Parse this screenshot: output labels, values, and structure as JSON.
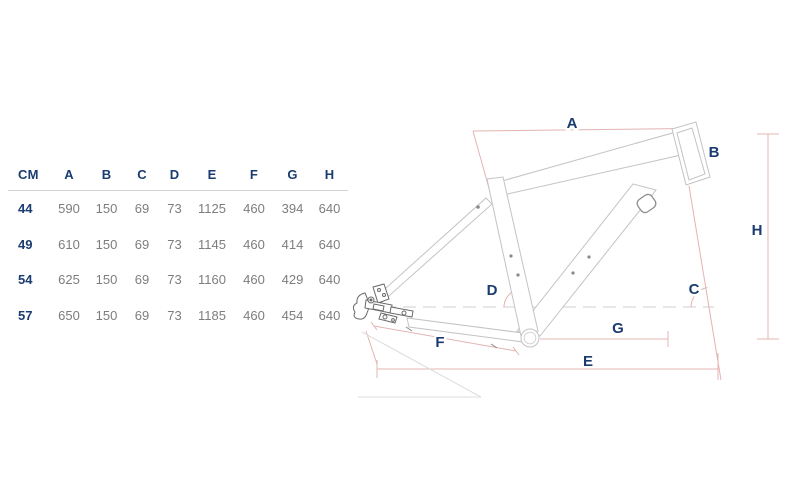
{
  "table": {
    "unit_header": "CM",
    "columns": [
      "A",
      "B",
      "C",
      "D",
      "E",
      "F",
      "G",
      "H"
    ],
    "rows": [
      {
        "size": "44",
        "values": [
          "590",
          "150",
          "69",
          "73",
          "1125",
          "460",
          "394",
          "640"
        ]
      },
      {
        "size": "49",
        "values": [
          "610",
          "150",
          "69",
          "73",
          "1145",
          "460",
          "414",
          "640"
        ]
      },
      {
        "size": "54",
        "values": [
          "625",
          "150",
          "69",
          "73",
          "1160",
          "460",
          "429",
          "640"
        ]
      },
      {
        "size": "57",
        "values": [
          "650",
          "150",
          "69",
          "73",
          "1185",
          "460",
          "454",
          "640"
        ]
      }
    ]
  },
  "diagram": {
    "labels": {
      "A": "A",
      "B": "B",
      "C": "C",
      "D": "D",
      "E": "E",
      "F": "F",
      "G": "G",
      "H": "H"
    }
  },
  "colors": {
    "label_navy": "#1a3c70",
    "value_gray": "#7d7d7d",
    "dimension_pink": "#e3b4b2",
    "frame_gray": "#c3c3c3"
  }
}
